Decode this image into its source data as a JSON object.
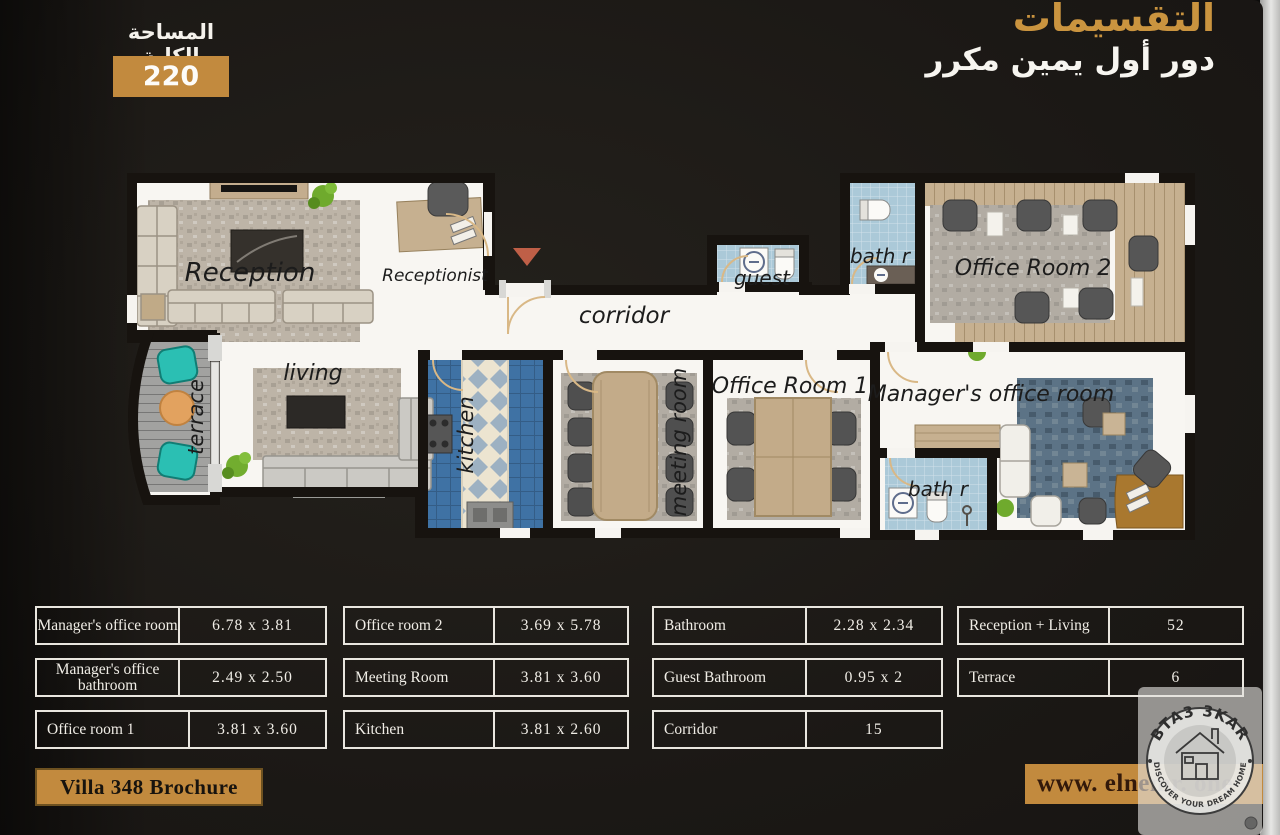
{
  "header": {
    "title": "التقسيمات",
    "subtitle": "دور أول يمين مكرر",
    "total_area_label": "المساحة الكلية",
    "total_area_value": "220"
  },
  "plan": {
    "reception": "Reception",
    "receptionist": "Receptionist",
    "corridor": "corridor",
    "guest": "guest",
    "bath_top": "bath r",
    "office_room_2": "Office Room 2",
    "living": "living",
    "terrace": "terrace",
    "kitchen": "kitchen",
    "meeting_room": "meeting room",
    "office_room_1": "Office Room 1",
    "managers_office": "Manager's office room",
    "bath_manager": "bath r"
  },
  "tables": [
    {
      "rows": [
        {
          "label": "Manager's office room",
          "value": "6.78 x 3.81"
        },
        {
          "label": "Manager's office bathroom",
          "value": "2.49 x 2.50"
        },
        {
          "label": "Office room 1",
          "value": "3.81 x 3.60"
        }
      ]
    },
    {
      "rows": [
        {
          "label": "Office room 2",
          "value": "3.69 x 5.78"
        },
        {
          "label": "Meeting Room",
          "value": "3.81 x 3.60"
        },
        {
          "label": "Kitchen",
          "value": "3.81 x 2.60"
        }
      ]
    },
    {
      "rows": [
        {
          "label": "Bathroom",
          "value": "2.28 x 2.34"
        },
        {
          "label": "Guest Bathroom",
          "value": "0.95 x 2"
        },
        {
          "label": "Corridor",
          "value": "15"
        }
      ]
    },
    {
      "rows": [
        {
          "label": "Reception + Living",
          "value": "52"
        },
        {
          "label": "Terrace",
          "value": "6"
        }
      ]
    }
  ],
  "footer": {
    "brochure": "Villa 348 Brochure",
    "website": "www. elnemr. one"
  },
  "watermark": {
    "brand": "BTA3 3KAR",
    "tagline": "DISCOVER YOUR DREAM HOME"
  },
  "colors": {
    "gold": "#c28a3e",
    "title_gold": "#ca943f",
    "tile_blue": "#abc9d8",
    "kitchen_blue": "#3f72a4",
    "teal_chair": "#2bbfb3"
  }
}
